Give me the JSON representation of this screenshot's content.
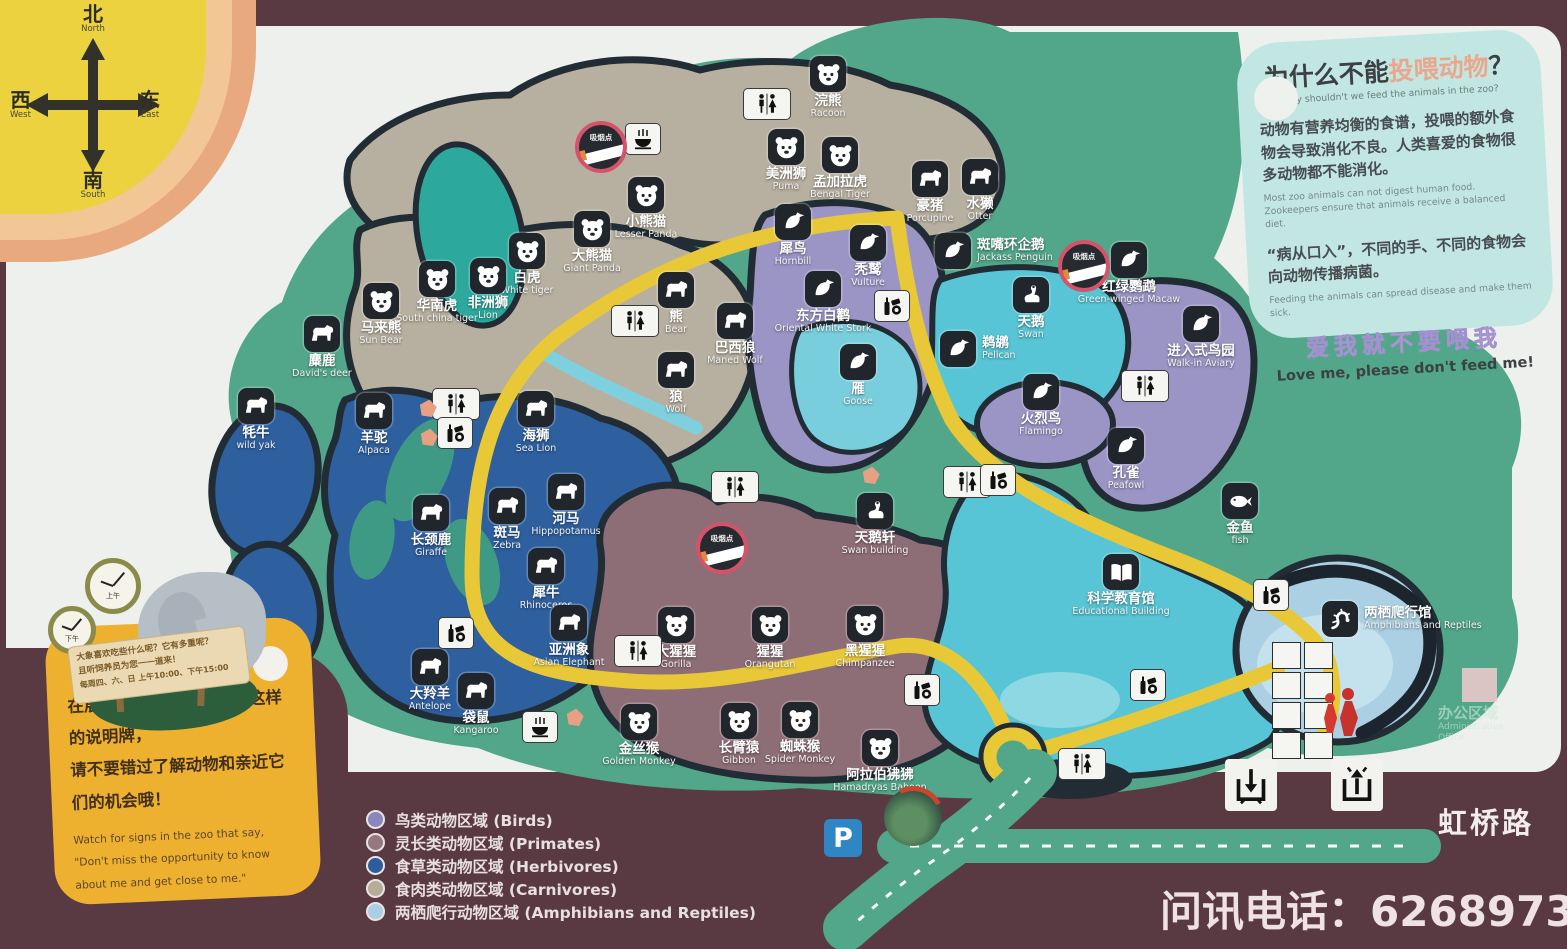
{
  "compass": {
    "north_cn": "北",
    "north_en": "North",
    "east_cn": "东",
    "east_en": "East",
    "south_cn": "南",
    "south_en": "South",
    "west_cn": "西",
    "west_en": "West"
  },
  "info_panel": {
    "title_prefix": "为什么不能",
    "title_highlight": "投喂动物",
    "title_question": "？",
    "subtitle_en": "Why shouldn't we feed the animals in the zoo?",
    "para1_cn": "动物有营养均衡的食谱，投喂的额外食物会导致消化不良。人类喜爱的食物很多动物都不能消化。",
    "para1_en": "Most zoo animals can not digest human food. Zookeepers ensure that animals receive a balanced diet.",
    "para2_cn": "“病从口入”，不同的手、不同的食物会向动物传播病菌。",
    "para2_en": "Feeding the animals can spread disease and make them sick.",
    "slogan_cn": "爱我就不要喂我",
    "slogan_en": "Love me, please don't feed me!"
  },
  "sign_card": {
    "line1_cn": "在展区里，您会看到类似这样的说明牌，",
    "line2_cn": "请不要错过了解动物和亲近它们的机会哦！",
    "en": "Watch for signs in the zoo that say, \"Don't miss the opportunity to know about me and get close to me.\"",
    "board_line1": "大象喜欢吃些什么呢？它有多重呢？",
    "board_line2": "且听饲养员为您一一道来！",
    "board_line3": "每周四、六、日 上午10:00、下午15:00",
    "clock_am": "上午",
    "clock_pm": "下午"
  },
  "legend": [
    {
      "label": "鸟类动物区域 (Birds)",
      "color": "#8b87bd"
    },
    {
      "label": "灵长类动物区域 (Primates)",
      "color": "#947a80"
    },
    {
      "label": "食草类动物区域 (Herbivores)",
      "color": "#2e5c9e"
    },
    {
      "label": "食肉类动物区域 (Carnivores)",
      "color": "#b5ad97"
    },
    {
      "label": "两栖爬行动物区域 (Amphibians and Reptiles)",
      "color": "#a9cfe4"
    }
  ],
  "footer": {
    "road_label": "虹桥路",
    "phone_label": "问讯电话：",
    "phone_number": "62689733",
    "parking": "P"
  },
  "admin": {
    "cn": "办公区域",
    "en1": "Administrative",
    "en2": "Office"
  },
  "pois": [
    {
      "cn": "浣熊",
      "en": "Racoon",
      "x": 828,
      "y": 56,
      "icon": "#face-icon"
    },
    {
      "cn": "美洲狮",
      "en": "Puma",
      "x": 786,
      "y": 129,
      "icon": "#face-icon"
    },
    {
      "cn": "孟加拉虎",
      "en": "Bengal Tiger",
      "x": 840,
      "y": 137,
      "icon": "#face-icon"
    },
    {
      "cn": "豪猪",
      "en": "Porcupine",
      "x": 930,
      "y": 161,
      "icon": "#quadruped-icon"
    },
    {
      "cn": "水獭",
      "en": "Otter",
      "x": 980,
      "y": 159,
      "icon": "#quadruped-icon"
    },
    {
      "cn": "小熊猫",
      "en": "Lesser Panda",
      "x": 646,
      "y": 177,
      "icon": "#face-icon"
    },
    {
      "cn": "大熊猫",
      "en": "Giant Panda",
      "x": 592,
      "y": 211,
      "icon": "#face-icon"
    },
    {
      "cn": "白虎",
      "en": "White tiger",
      "x": 527,
      "y": 233,
      "icon": "#face-icon"
    },
    {
      "cn": "华南虎",
      "en": "South china tiger",
      "x": 437,
      "y": 261,
      "icon": "#face-icon"
    },
    {
      "cn": "非洲狮",
      "en": "Lion",
      "x": 488,
      "y": 258,
      "icon": "#face-icon"
    },
    {
      "cn": "马来熊",
      "en": "Sun Bear",
      "x": 381,
      "y": 283,
      "icon": "#face-icon"
    },
    {
      "cn": "麋鹿",
      "en": "David's deer",
      "x": 322,
      "y": 316,
      "icon": "#quadruped-icon"
    },
    {
      "cn": "熊",
      "en": "Bear",
      "x": 676,
      "y": 272,
      "icon": "#quadruped-icon"
    },
    {
      "cn": "巴西狼",
      "en": "Maned Wolf",
      "x": 735,
      "y": 303,
      "icon": "#quadruped-icon"
    },
    {
      "cn": "狼",
      "en": "Wolf",
      "x": 676,
      "y": 352,
      "icon": "#quadruped-icon"
    },
    {
      "cn": "犀鸟",
      "en": "Hornbill",
      "x": 793,
      "y": 204,
      "icon": "#bird-icon"
    },
    {
      "cn": "秃鹫",
      "en": "Vulture",
      "x": 868,
      "y": 225,
      "icon": "#bird-icon"
    },
    {
      "cn": "东方白鹳",
      "en": "Oriental White Stork",
      "x": 823,
      "y": 271,
      "icon": "#bird-icon"
    },
    {
      "cn": "雁",
      "en": "Goose",
      "x": 858,
      "y": 344,
      "icon": "#bird-icon"
    },
    {
      "cn": "斑嘴环企鹅",
      "en": "Jackass Penguin",
      "x": 953,
      "y": 233,
      "icon": "#bird-icon",
      "lp": "right"
    },
    {
      "cn": "红绿鹦鹉",
      "en": "Green-winged Macaw",
      "x": 1129,
      "y": 242,
      "icon": "#bird-icon"
    },
    {
      "cn": "天鹅",
      "en": "Swan",
      "x": 1031,
      "y": 277,
      "icon": "#swan-icon"
    },
    {
      "cn": "鹈鹕",
      "en": "Pelican",
      "x": 958,
      "y": 331,
      "icon": "#bird-icon",
      "lp": "right"
    },
    {
      "cn": "进入式鸟园",
      "en": "Walk-in Aviary",
      "x": 1201,
      "y": 306,
      "icon": "#bird-icon"
    },
    {
      "cn": "火烈鸟",
      "en": "Flamingo",
      "x": 1041,
      "y": 374,
      "icon": "#bird-icon"
    },
    {
      "cn": "孔雀",
      "en": "Peafowl",
      "x": 1126,
      "y": 428,
      "icon": "#bird-icon"
    },
    {
      "cn": "金鱼",
      "en": "fish",
      "x": 1240,
      "y": 483,
      "icon": "#fish-icon"
    },
    {
      "cn": "海狮",
      "en": "Sea Lion",
      "x": 536,
      "y": 391,
      "icon": "#quadruped-icon"
    },
    {
      "cn": "牦牛",
      "en": "wild yak",
      "x": 256,
      "y": 388,
      "icon": "#quadruped-icon"
    },
    {
      "cn": "羊驼",
      "en": "Alpaca",
      "x": 374,
      "y": 393,
      "icon": "#quadruped-icon"
    },
    {
      "cn": "长颈鹿",
      "en": "Giraffe",
      "x": 431,
      "y": 495,
      "icon": "#quadruped-icon"
    },
    {
      "cn": "斑马",
      "en": "Zebra",
      "x": 507,
      "y": 488,
      "icon": "#quadruped-icon"
    },
    {
      "cn": "河马",
      "en": "Hippopotamus",
      "x": 566,
      "y": 474,
      "icon": "#quadruped-icon"
    },
    {
      "cn": "犀牛",
      "en": "Rhinoceros",
      "x": 546,
      "y": 548,
      "icon": "#quadruped-icon"
    },
    {
      "cn": "亚洲象",
      "en": "Asian Elephant",
      "x": 569,
      "y": 605,
      "icon": "#quadruped-icon"
    },
    {
      "cn": "大猩猩",
      "en": "Gorilla",
      "x": 676,
      "y": 607,
      "icon": "#face-icon"
    },
    {
      "cn": "猩猩",
      "en": "Orangutan",
      "x": 770,
      "y": 607,
      "icon": "#face-icon"
    },
    {
      "cn": "黑猩猩",
      "en": "Chimpanzee",
      "x": 865,
      "y": 606,
      "icon": "#face-icon"
    },
    {
      "cn": "大羚羊",
      "en": "Antelope",
      "x": 430,
      "y": 649,
      "icon": "#quadruped-icon"
    },
    {
      "cn": "袋鼠",
      "en": "Kangaroo",
      "x": 476,
      "y": 673,
      "icon": "#quadruped-icon"
    },
    {
      "cn": "金丝猴",
      "en": "Golden Monkey",
      "x": 639,
      "y": 704,
      "icon": "#face-icon"
    },
    {
      "cn": "长臂猿",
      "en": "Gibbon",
      "x": 739,
      "y": 703,
      "icon": "#face-icon"
    },
    {
      "cn": "蜘蛛猴",
      "en": "Spider Monkey",
      "x": 800,
      "y": 702,
      "icon": "#face-icon"
    },
    {
      "cn": "阿拉伯狒狒",
      "en": "Hamadryas Baboon",
      "x": 880,
      "y": 730,
      "icon": "#face-icon"
    },
    {
      "cn": "天鹅轩",
      "en": "Swan building",
      "x": 875,
      "y": 493,
      "icon": "#swan-icon"
    },
    {
      "cn": "科学教育馆",
      "en": "Educational Building",
      "x": 1121,
      "y": 554,
      "icon": "#book-icon"
    },
    {
      "cn": "两栖爬行馆",
      "en": "Amphibians and Reptiles",
      "x": 1340,
      "y": 601,
      "icon": "#lizard-icon",
      "lp": "right"
    }
  ],
  "facilities": {
    "toilets": [
      {
        "x": 767,
        "y": 104
      },
      {
        "x": 635,
        "y": 321
      },
      {
        "x": 456,
        "y": 404
      },
      {
        "x": 735,
        "y": 487
      },
      {
        "x": 967,
        "y": 482
      },
      {
        "x": 1145,
        "y": 386
      },
      {
        "x": 638,
        "y": 651
      },
      {
        "x": 1082,
        "y": 764
      }
    ],
    "vending": [
      {
        "x": 455,
        "y": 433
      },
      {
        "x": 892,
        "y": 306
      },
      {
        "x": 998,
        "y": 480
      },
      {
        "x": 456,
        "y": 633
      },
      {
        "x": 922,
        "y": 690
      },
      {
        "x": 1148,
        "y": 685
      },
      {
        "x": 1271,
        "y": 595
      }
    ],
    "restaurants": [
      {
        "x": 643,
        "y": 139
      },
      {
        "x": 540,
        "y": 727
      }
    ],
    "smoking": [
      {
        "x": 601,
        "y": 147,
        "label": "吸烟点"
      },
      {
        "x": 1084,
        "y": 266,
        "label": "吸烟点"
      },
      {
        "x": 722,
        "y": 548,
        "label": "吸烟点"
      }
    ],
    "pentagons": [
      {
        "x": 428,
        "y": 408
      },
      {
        "x": 429,
        "y": 437
      },
      {
        "x": 575,
        "y": 717
      },
      {
        "x": 871,
        "y": 475
      }
    ],
    "service_grid": [
      {
        "g": "▦",
        "name": "locker-icon"
      },
      {
        "g": "▨",
        "name": "recharge-icon"
      },
      {
        "g": "☎",
        "name": "telephone-icon"
      },
      {
        "g": "◉",
        "name": "camera-icon"
      },
      {
        "g": "?",
        "name": "inquiry-icon"
      },
      {
        "g": "♂♀",
        "name": "toilets-icon"
      },
      {
        "g": "✎",
        "name": "registration-icon"
      },
      {
        "g": "i",
        "name": "information-icon"
      }
    ]
  }
}
